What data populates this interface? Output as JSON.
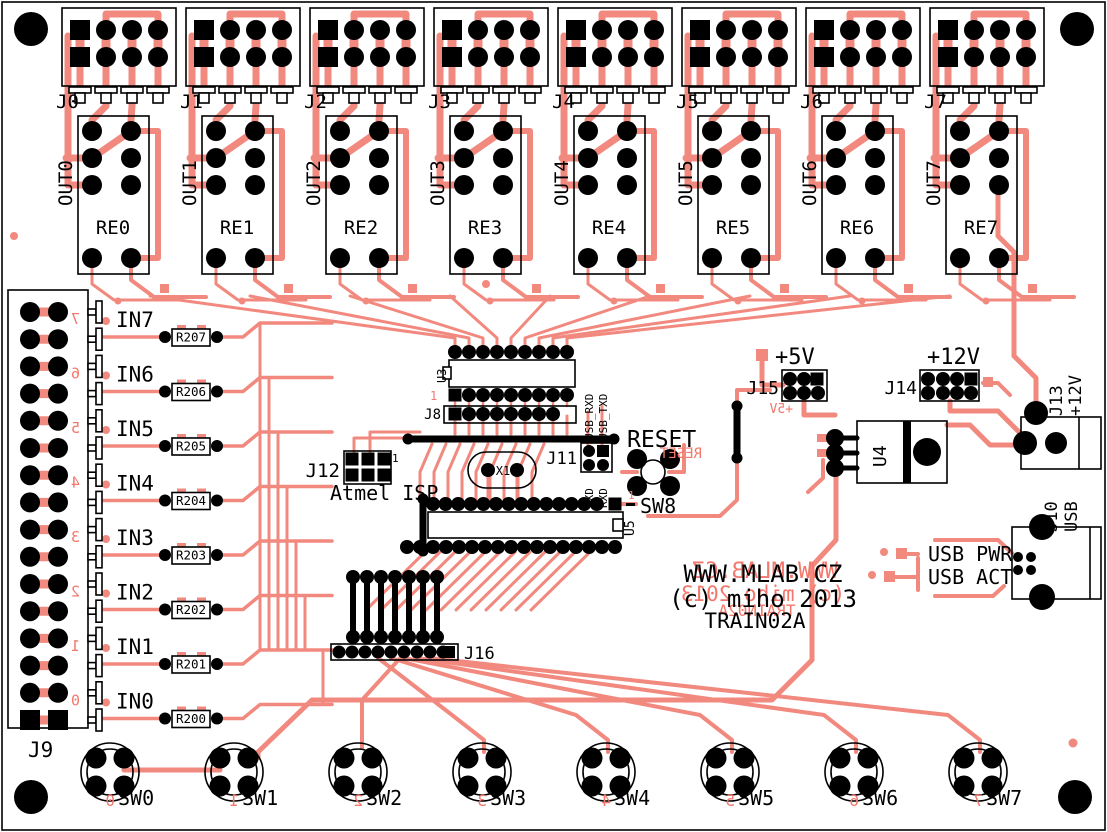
{
  "board": {
    "site": "WWW.MLAB.CZ",
    "copyright": "(c) miho 2013",
    "name": "TRAIN02A",
    "pin1_mark": "1",
    "colors": {
      "copper": "#f2897f",
      "bottom_silk": "#f4776c",
      "silk": "#000000",
      "bg": "#ffffff"
    }
  },
  "relay_modules": [
    {
      "connector": "J0",
      "relay": "RE0",
      "output": "OUT0"
    },
    {
      "connector": "J1",
      "relay": "RE1",
      "output": "OUT1"
    },
    {
      "connector": "J2",
      "relay": "RE2",
      "output": "OUT2"
    },
    {
      "connector": "J3",
      "relay": "RE3",
      "output": "OUT3"
    },
    {
      "connector": "J4",
      "relay": "RE4",
      "output": "OUT4"
    },
    {
      "connector": "J5",
      "relay": "RE5",
      "output": "OUT5"
    },
    {
      "connector": "J6",
      "relay": "RE6",
      "output": "OUT6"
    },
    {
      "connector": "J7",
      "relay": "RE7",
      "output": "OUT7"
    }
  ],
  "input_connector": {
    "label": "J9"
  },
  "input_channels": [
    {
      "label": "IN7",
      "resistor": "R207",
      "pin_mark": "7"
    },
    {
      "label": "IN6",
      "resistor": "R206",
      "pin_mark": "6"
    },
    {
      "label": "IN5",
      "resistor": "R205",
      "pin_mark": "5"
    },
    {
      "label": "IN4",
      "resistor": "R204",
      "pin_mark": "4"
    },
    {
      "label": "IN3",
      "resistor": "R203",
      "pin_mark": "3"
    },
    {
      "label": "IN2",
      "resistor": "R202",
      "pin_mark": "2"
    },
    {
      "label": "IN1",
      "resistor": "R201",
      "pin_mark": "1"
    },
    {
      "label": "IN0",
      "resistor": "R200",
      "pin_mark": "0"
    }
  ],
  "switches": [
    {
      "label": "SW0",
      "mark": "0"
    },
    {
      "label": "SW1",
      "mark": "1"
    },
    {
      "label": "SW2",
      "mark": "2"
    },
    {
      "label": "SW3",
      "mark": "3"
    },
    {
      "label": "SW4",
      "mark": "4"
    },
    {
      "label": "SW5",
      "mark": "5"
    },
    {
      "label": "SW6",
      "mark": "6"
    },
    {
      "label": "SW7",
      "mark": "7"
    }
  ],
  "mcu": {
    "socket": "U5",
    "driver": "U3",
    "header_j8": "J8",
    "crystal": "X1",
    "expansion": "J16",
    "isp": {
      "label": "J12",
      "title": "Atmel ISP"
    },
    "serial": {
      "label": "J11",
      "top": [
        "USB_RXD",
        "USB_TXD"
      ],
      "bottom": [
        "TXD",
        "RXD"
      ]
    },
    "reset": {
      "title": "RESET",
      "button": "SW8"
    }
  },
  "power": {
    "v5": {
      "title": "+5V",
      "header": "J15"
    },
    "v12": {
      "title": "+12V",
      "header": "J14"
    },
    "regulator": "U4",
    "jack": {
      "label": "J13",
      "voltage": "+12V"
    }
  },
  "usb": {
    "connector": {
      "label": "J10",
      "title": "USB"
    },
    "leds": [
      "USB PWR",
      "USB ACT"
    ]
  }
}
